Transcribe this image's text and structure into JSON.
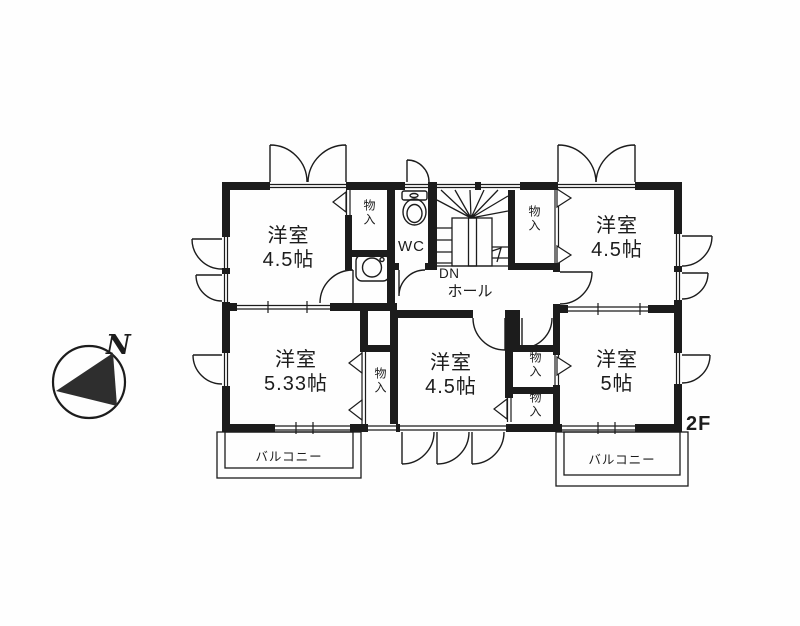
{
  "floor": {
    "label": "2F"
  },
  "compass": {
    "north_label": "N"
  },
  "rooms": [
    {
      "id": "bedroom-top-left",
      "name": "洋室",
      "size": "4.5帖"
    },
    {
      "id": "bedroom-top-right",
      "name": "洋室",
      "size": "4.5帖"
    },
    {
      "id": "bedroom-bottom-left",
      "name": "洋室",
      "size": "5.33帖"
    },
    {
      "id": "bedroom-bottom-middle",
      "name": "洋室",
      "size": "4.5帖"
    },
    {
      "id": "bedroom-bottom-right",
      "name": "洋室",
      "size": "5帖"
    }
  ],
  "features": {
    "wc": "WC",
    "hall": "ホール",
    "stairs_down": "DN",
    "closet": "物入",
    "balcony": "バルコニー"
  },
  "colors": {
    "wall": "#1c1c1c",
    "line": "#1c1c1c",
    "compass_fill": "#2e2e2e"
  }
}
